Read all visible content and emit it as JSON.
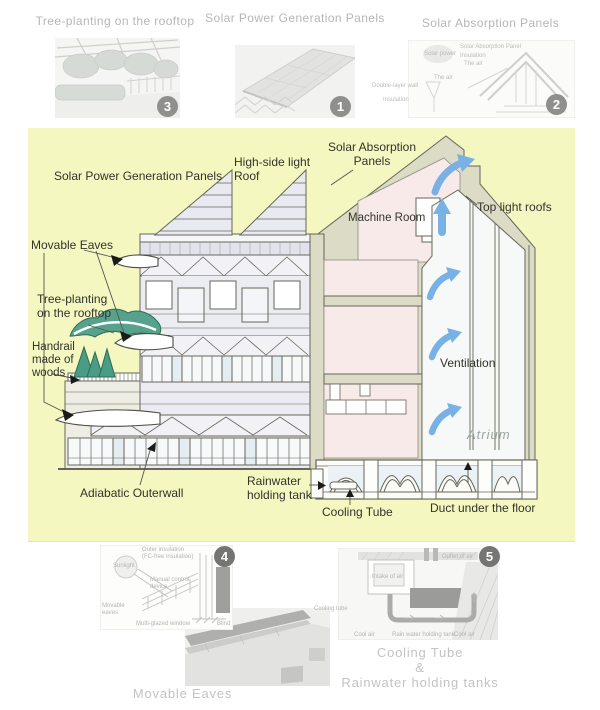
{
  "top_figures": [
    {
      "caption": "Tree-planting on the rooftop",
      "badge": "3"
    },
    {
      "caption": "Solar Power Generation Panels",
      "badge": "1"
    },
    {
      "caption": "Solar Absorption Panels",
      "badge": "2",
      "labels": {
        "panel": "Solar Absorption Panel",
        "insulation_top": "Insulation",
        "air1": "The air",
        "solar_power": "Solar power",
        "air2": "The air",
        "double_wall": "Double-layer wall",
        "insulation_bottom": "Insulation"
      }
    }
  ],
  "diagram": {
    "labels": {
      "solar_power_panels": "Solar Power Generation Panels",
      "high_side_1": "High-side light",
      "high_side_2": "Roof",
      "solar_absorption_1": "Solar Absorption",
      "solar_absorption_2": "Panels",
      "machine_room": "Machine Room",
      "top_light_roofs": "Top light roofs",
      "movable_eaves": "Movable Eaves",
      "tree_planting_1": "Tree-planting",
      "tree_planting_2": "on the rooftop",
      "handrail_1": "Handrail",
      "handrail_2": "made of",
      "handrail_3": "woods",
      "ventilation": "Ventilation",
      "atrium": "Atrium",
      "adiabatic": "Adiabatic Outerwall",
      "rainwater_1": "Rainwater",
      "rainwater_2": "holding tank",
      "cooling_tube": "Cooling Tube",
      "duct": "Duct under the floor"
    }
  },
  "bottom_figures": [
    {
      "caption": "Movable Eaves",
      "badge": "4",
      "labels": {
        "outer_1": "Outer insulation",
        "outer_2": "(FC-free insulation)",
        "sunlight": "Sunlight",
        "control": "Manual control device",
        "movable": "Movable eaves",
        "window": "Multi-glazed window",
        "blind": "Blind"
      }
    },
    {
      "caption_1": "Cooling Tube",
      "caption_2": "&",
      "caption_3": "Rainwater holding tanks",
      "badge": "5",
      "labels": {
        "intake": "Intake of air",
        "outlet": "Outlet of air",
        "tube": "Cooling tube",
        "cool_1": "Cool air",
        "tank": "Rain water holding tank",
        "cool_2": "Cool air"
      }
    }
  ],
  "colors": {
    "panel_bg": "#f4f7c0",
    "arrow_blue": "#79b1e5",
    "tree_green": "#4a9c86",
    "cut_wall": "#dcdbc5",
    "room_pink": "#f8eae8",
    "facade": "#ecebf3",
    "caption_gray": "#b6b6b4",
    "label_dark": "#33332c",
    "badge_gray": "#8f8f8d"
  }
}
